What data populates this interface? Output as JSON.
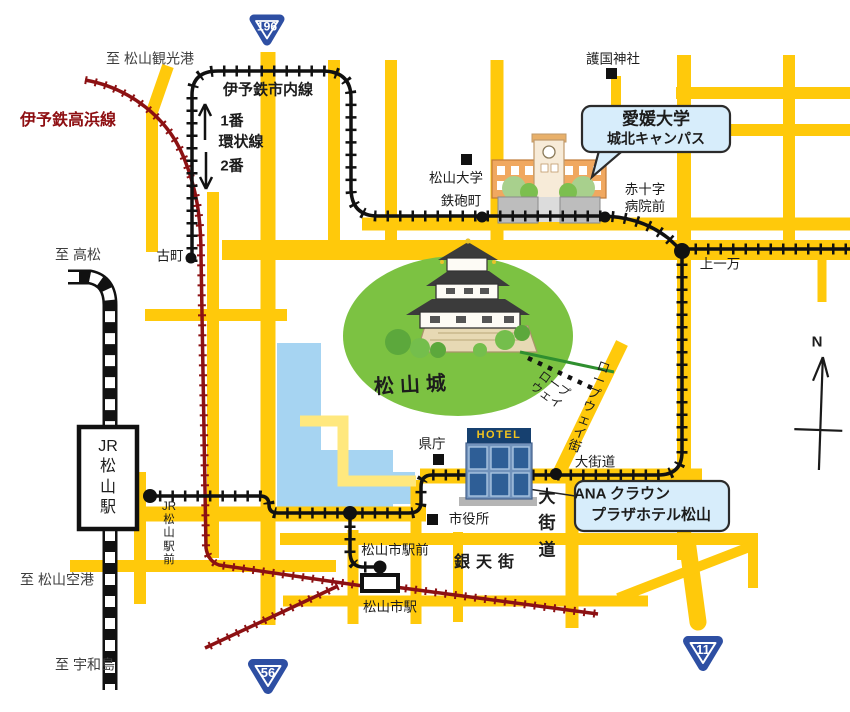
{
  "labels": {
    "to_kanko": "至 松山観光港",
    "takahama_line": "伊予鉄高浜線",
    "shinai_line": "伊予鉄市内線",
    "loop1": "1番",
    "kanjosen": "環状線",
    "loop2": "2番",
    "gokoku": "護国神社",
    "matsuyama_univ": "松山大学",
    "teppocho": "鉄砲町",
    "sekijuji": "赤十字\n病院前",
    "to_takamatsu": "至 高松",
    "komachi": "古町",
    "kamiichiman": "上一万",
    "matsuyamajo": "松山城",
    "ropeway": "ロープ\nウェイ",
    "ropeway_street": "ロ\nー\nプ\nウ\nェ\nイ\n街",
    "north": "N",
    "jr_station": "JR\n松\n山\n駅",
    "kencho": "県庁",
    "hotel_sign": "HOTEL",
    "okaido_stop": "大街道",
    "shiyakusho": "市役所",
    "jr_ekimae": "JR\n松\n山\n駅\n前",
    "okaido_street": "大\n街\n道",
    "gintengai": "銀天街",
    "shieki_mae": "松山市駅前",
    "shieki": "松山市駅",
    "to_airport": "至 松山空港",
    "to_uwajima": "至 宇和島"
  },
  "callouts": {
    "ehime_univ_line1": "愛媛大学",
    "ehime_univ_line2": "城北キャンパス",
    "ana_line1": "ANA クラウン",
    "ana_line2": "プラザホテル松山"
  },
  "shields": {
    "r196": "196",
    "r56": "56",
    "r11": "11"
  },
  "colors": {
    "road_yellow": "#FFC90B",
    "road_pale": "#FFE87E",
    "moat_blue": "#A6D4F2",
    "rail_red": "#8C1113",
    "park_green": "#7CC242",
    "callout_blue": "#D7EDFB",
    "shield_blue": "#2E4FA3",
    "hotel_navy": "#16406F",
    "hotel_gold": "#F2C41E"
  }
}
